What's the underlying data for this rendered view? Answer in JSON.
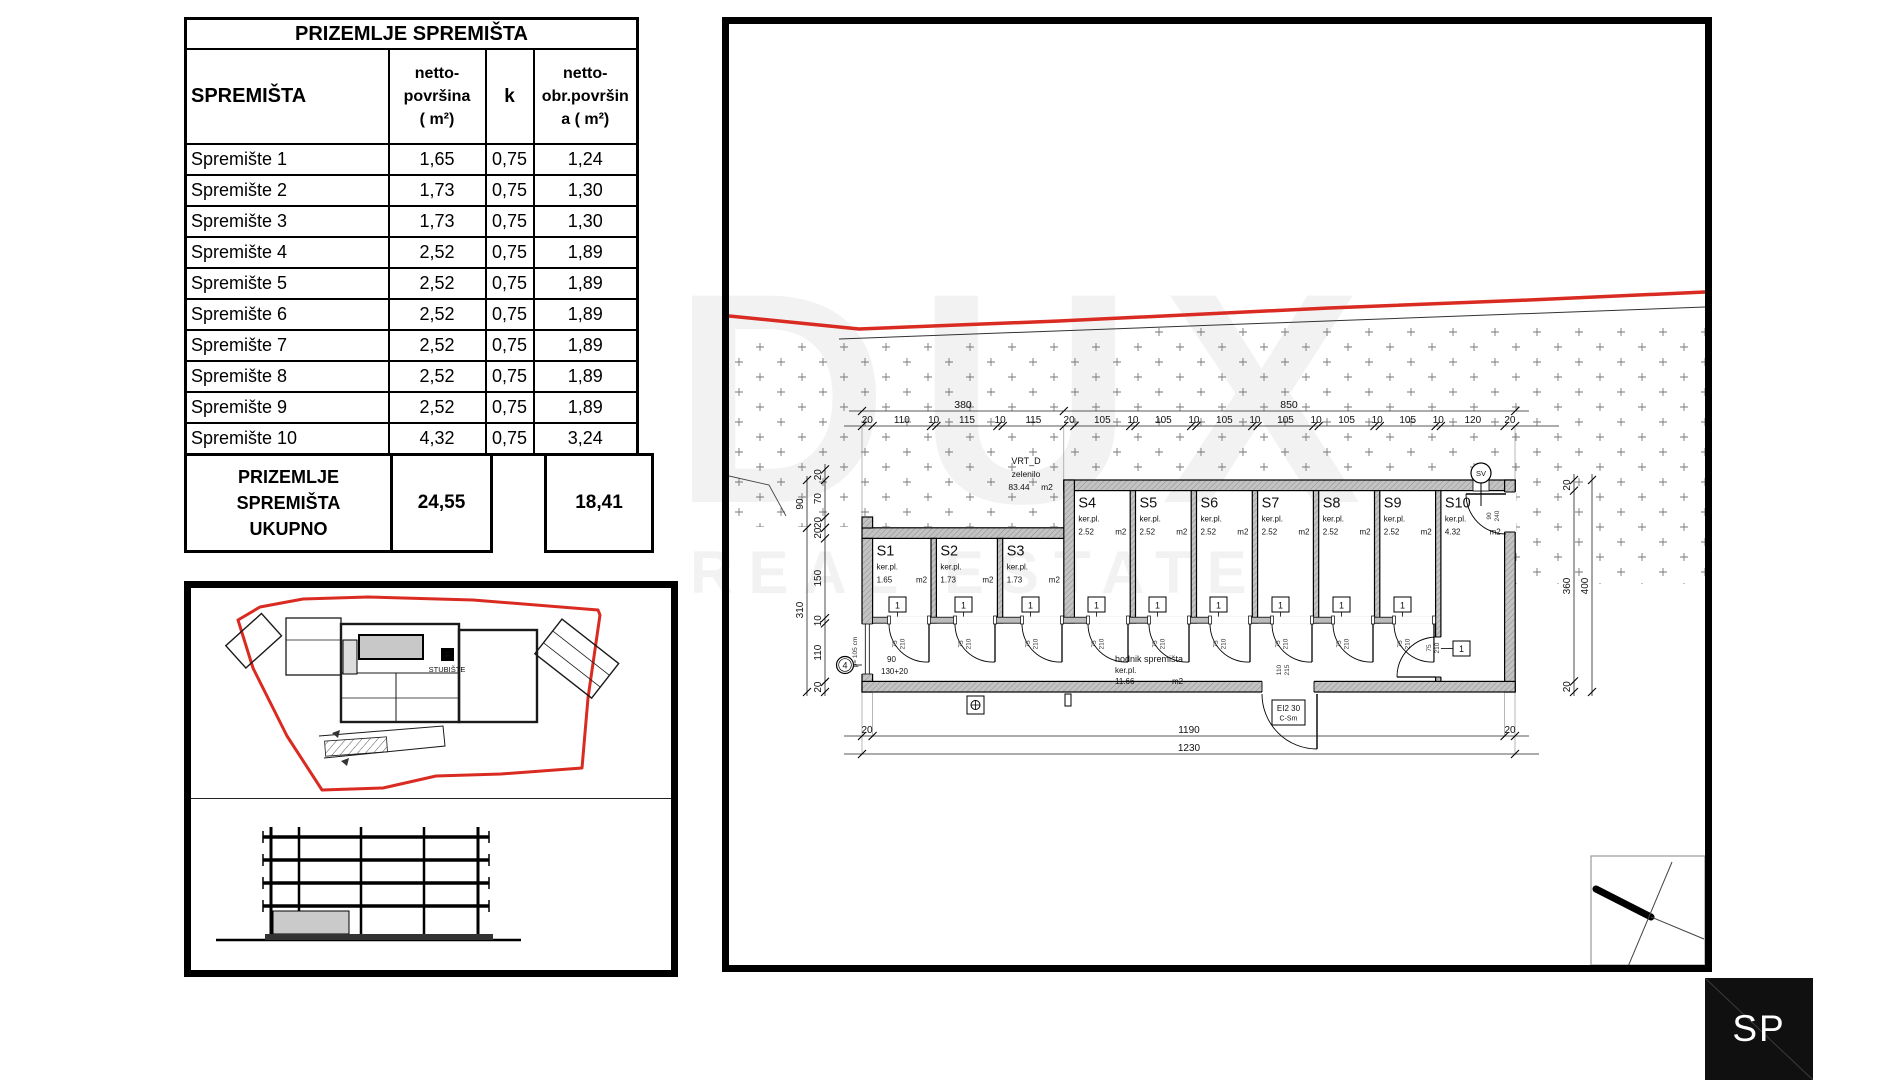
{
  "table": {
    "title": "PRIZEMLJE SPREMIŠTA",
    "headers": {
      "name": "SPREMIŠTA",
      "netto": [
        "netto-",
        "površina",
        "( m²)"
      ],
      "k": "k",
      "obr": [
        "netto-",
        "obr.površin",
        "a      ( m²)"
      ]
    },
    "rows": [
      {
        "name": "Spremište 1",
        "netto": "1,65",
        "k": "0,75",
        "obr": "1,24"
      },
      {
        "name": "Spremište 2",
        "netto": "1,73",
        "k": "0,75",
        "obr": "1,30"
      },
      {
        "name": "Spremište 3",
        "netto": "1,73",
        "k": "0,75",
        "obr": "1,30"
      },
      {
        "name": "Spremište 4",
        "netto": "2,52",
        "k": "0,75",
        "obr": "1,89"
      },
      {
        "name": "Spremište 5",
        "netto": "2,52",
        "k": "0,75",
        "obr": "1,89"
      },
      {
        "name": "Spremište 6",
        "netto": "2,52",
        "k": "0,75",
        "obr": "1,89"
      },
      {
        "name": "Spremište 7",
        "netto": "2,52",
        "k": "0,75",
        "obr": "1,89"
      },
      {
        "name": "Spremište 8",
        "netto": "2,52",
        "k": "0,75",
        "obr": "1,89"
      },
      {
        "name": "Spremište 9",
        "netto": "2,52",
        "k": "0,75",
        "obr": "1,89"
      },
      {
        "name": "Spremište 10",
        "netto": "4,32",
        "k": "0,75",
        "obr": "3,24"
      }
    ],
    "total": {
      "name_lines": [
        "PRIZEMLJE",
        "SPREMIŠTA",
        "UKUPNO"
      ],
      "netto": "24,55",
      "obr": "18,41"
    }
  },
  "site_plan": {
    "staircase_label": "STUBIŠTE",
    "staircase_icon": "F"
  },
  "plan": {
    "garden": {
      "name": "VRT_D",
      "type": "zelenilo",
      "area": "83.44",
      "unit": "m2"
    },
    "rooms": [
      {
        "id": "S1",
        "floor": "ker.pl.",
        "area": "1.65",
        "unit": "m2"
      },
      {
        "id": "S2",
        "floor": "ker.pl.",
        "area": "1.73",
        "unit": "m2"
      },
      {
        "id": "S3",
        "floor": "ker.pl.",
        "area": "1.73",
        "unit": "m2"
      },
      {
        "id": "S4",
        "floor": "ker.pl.",
        "area": "2.52",
        "unit": "m2"
      },
      {
        "id": "S5",
        "floor": "ker.pl.",
        "area": "2.52",
        "unit": "m2"
      },
      {
        "id": "S6",
        "floor": "ker.pl.",
        "area": "2.52",
        "unit": "m2"
      },
      {
        "id": "S7",
        "floor": "ker.pl.",
        "area": "2.52",
        "unit": "m2"
      },
      {
        "id": "S8",
        "floor": "ker.pl.",
        "area": "2.52",
        "unit": "m2"
      },
      {
        "id": "S9",
        "floor": "ker.pl.",
        "area": "2.52",
        "unit": "m2"
      },
      {
        "id": "S10",
        "floor": "ker.pl.",
        "area": "4.32",
        "unit": "m2"
      }
    ],
    "corridor": {
      "name": "hodnik spremišta",
      "floor": "ker.pl.",
      "area": "11.66",
      "unit": "m2"
    },
    "door_tag": "1",
    "door_w": "75",
    "door_h": "210",
    "exit_door_w": "110",
    "exit_door_h": "215",
    "exit_label_1": "EI2 30",
    "exit_label_2": "C-Sm",
    "sv": "SV",
    "axis": "4",
    "s10_door_w": "90",
    "s10_door_h": "240",
    "annot_90": "90",
    "annot_130": "130+20",
    "annot_p": "p= 105 cm",
    "dim_top_groups": [
      "380",
      "850"
    ],
    "dim_top_values": [
      "20",
      "110",
      "10",
      "115",
      "10",
      "115",
      "20",
      "105",
      "10",
      "105",
      "10",
      "105",
      "10",
      "105",
      "10",
      "105",
      "10",
      "105",
      "10",
      "120",
      "20"
    ],
    "dim_bottom_values": [
      "20",
      "1190",
      "20"
    ],
    "dim_bottom_total": "1230",
    "dim_left_values": [
      "20",
      "70",
      "20",
      "20",
      "150",
      "10",
      "110",
      "20"
    ],
    "dim_left_outer": [
      "90",
      "310"
    ],
    "dim_right_values": [
      "20",
      "360",
      "20"
    ],
    "dim_right_outer": "400"
  },
  "logo": {
    "text": "SP"
  },
  "watermark": {
    "line1": "DUX",
    "line2": "REAL ESTATE"
  },
  "colors": {
    "red": "#d92b21",
    "wall": "#c3c3c3",
    "ink": "#000000"
  }
}
